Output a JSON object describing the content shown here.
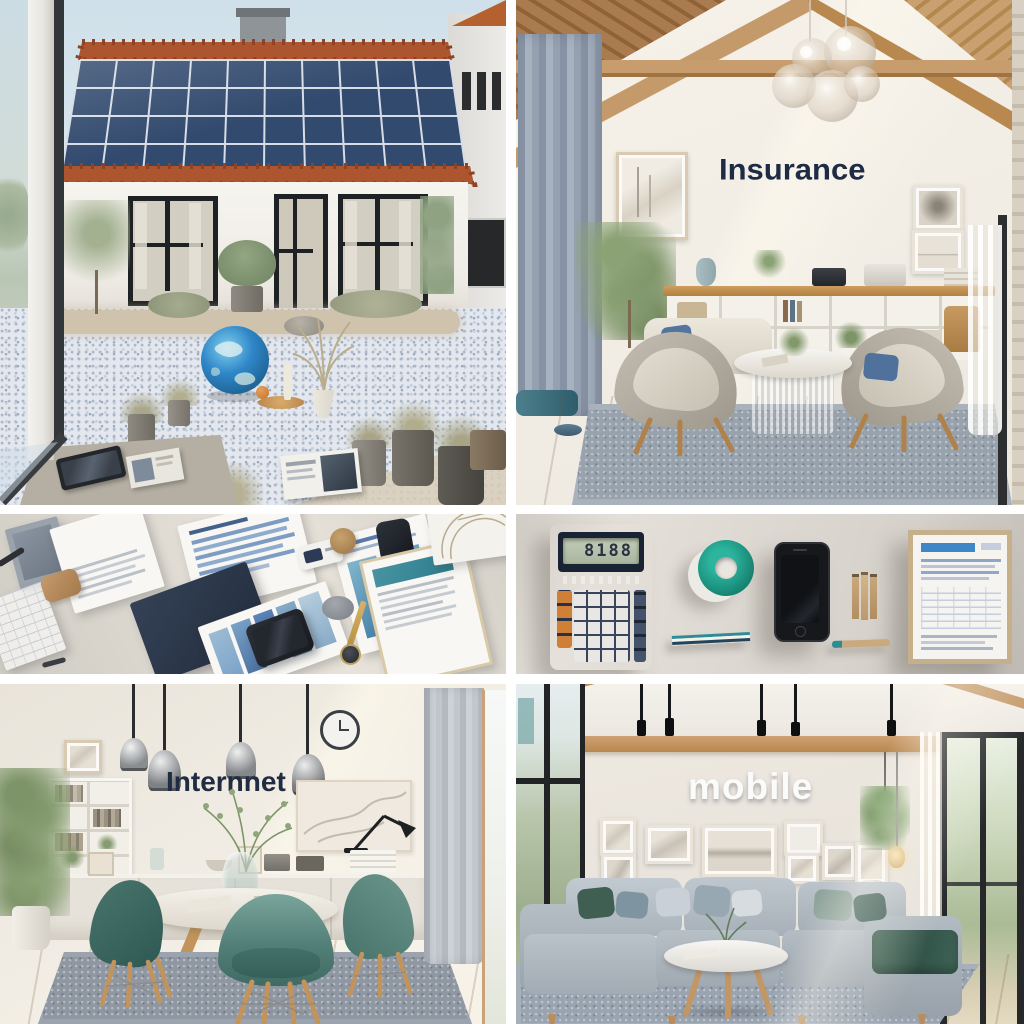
{
  "image": {
    "kind": "photo-collage",
    "grid": "2 columns x 3 rows",
    "divider_color": "#ffffff"
  },
  "texts": {
    "insurance_wall": "Insurance",
    "internet_wall": "Internnet",
    "mobile_wall": "mobile",
    "calculator_display": "8188"
  },
  "panels": [
    {
      "id": "solar-home",
      "wall_text": ""
    },
    {
      "id": "insurance-room",
      "wall_text": "Insurance"
    },
    {
      "id": "documents-flatlay",
      "wall_text": ""
    },
    {
      "id": "calculator-flatlay",
      "wall_text": ""
    },
    {
      "id": "internet-room",
      "wall_text": "Internnet"
    },
    {
      "id": "mobile-room",
      "wall_text": "mobile"
    }
  ],
  "palette": {
    "sky": "#cfe0ea",
    "solar_panel_blue": "#324a6e",
    "roof_tile_terracotta": "#ad552e",
    "wall_cream": "#f1ede5",
    "wood_beam": "#c49a6a",
    "navy_text": "#1d2b45",
    "teal_accent": "#1f9c8c",
    "chair_teal": "#4a7a72",
    "rug_grey": "#98a2ac",
    "floor_wood": "#dcba8c",
    "globe_blue": "#2f86c8"
  }
}
